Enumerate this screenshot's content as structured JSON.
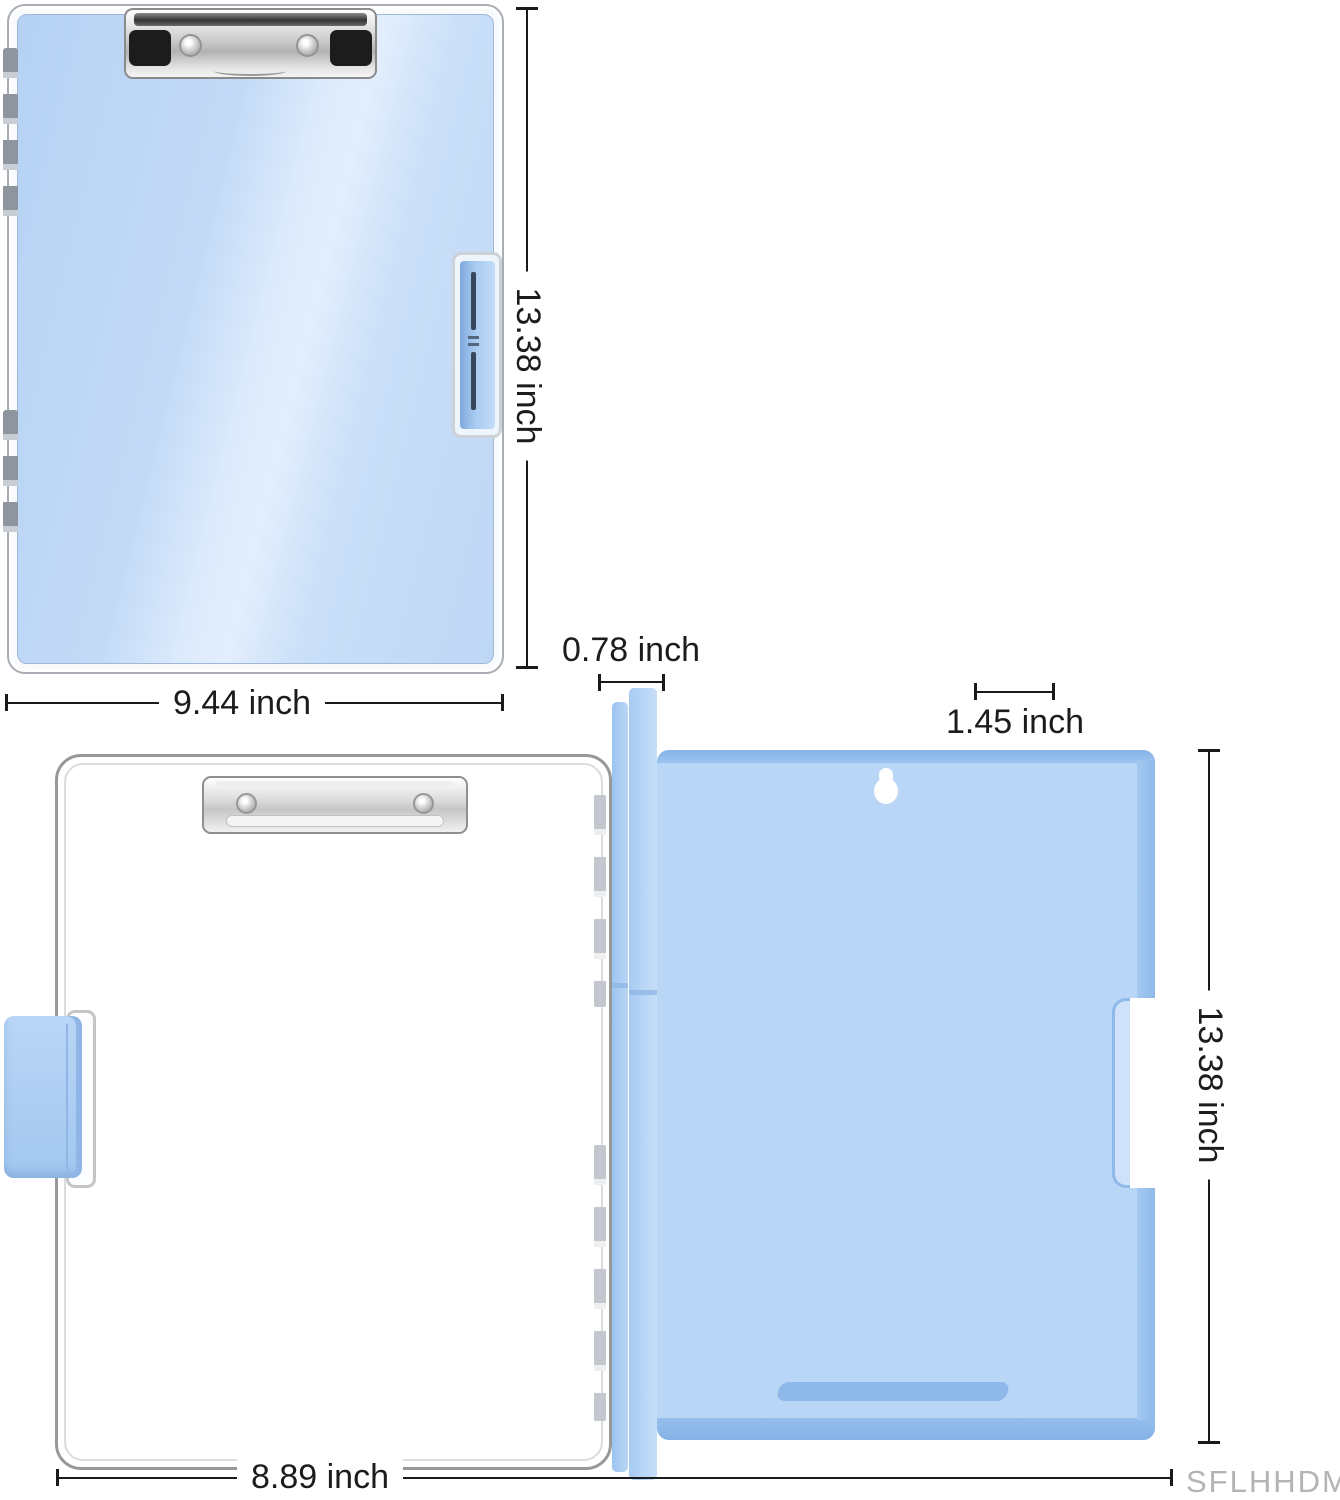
{
  "dims": {
    "closed_height": "13.38 inch",
    "closed_width": "9.44 inch",
    "spine_thickness": "0.78 inch",
    "side_width": "1.45 inch",
    "open_height": "13.38 inch",
    "open_width": "8.89 inch"
  },
  "watermark": "SFLHHDM",
  "colors": {
    "front_blue": "#c3daf7",
    "front_highlight": "#e2eefd",
    "back_panel_blue": "#bad6f6",
    "panel_edge_blue": "#8fb9ea",
    "spine_blue": "#a6cbf2",
    "latch_tab_blue": "#a9ccf1",
    "metal_light": "#f5f5f5",
    "metal_dark": "#8a8a8a",
    "clip_black": "#1c1c1c",
    "dimension_line": "#1a1a1a",
    "label_text": "#1c1c1c",
    "watermark_gray": "#b4b4b4",
    "background": "#ffffff"
  }
}
